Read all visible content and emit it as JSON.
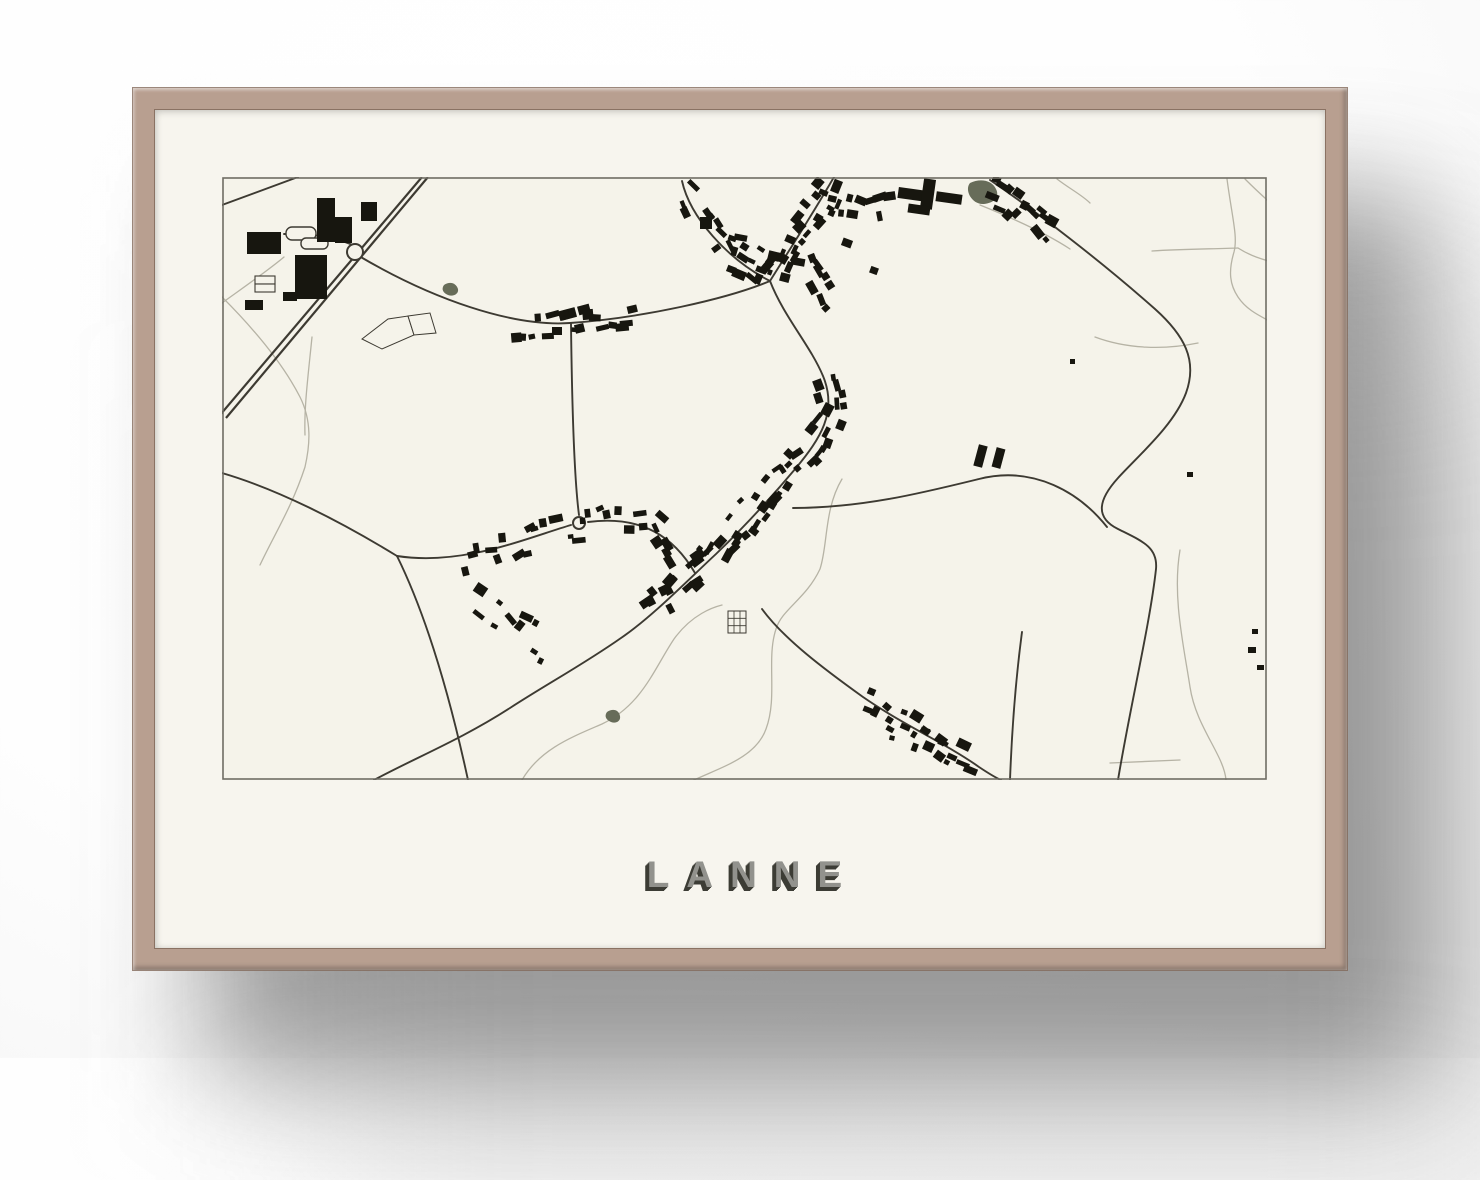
{
  "poster": {
    "title": "LANNE"
  },
  "colors": {
    "frame": "#b89f90",
    "frame_dark": "#8a7263",
    "mat": "#f7f5ee",
    "map_bg": "#f5f3ea",
    "map_border": "#6f6d64",
    "road_dark": "#3d3a32",
    "road_light": "#b6b3a5",
    "building": "#17160f",
    "water": "#676c59",
    "title_fill": "#92928d",
    "title_shadow": "#3c3c35"
  },
  "map": {
    "width": 1045,
    "height": 603,
    "highway": [
      "M206,0 L4,241",
      "M200,0 L-2,238"
    ],
    "roads_dark": [
      "M0,28 L76,0",
      "M137,79 C210,122 290,150 348,146 C420,141 505,122 548,104",
      "M460,4 C468,40 505,82 548,104",
      "M548,104 C568,72 590,38 612,0",
      "M548,104 C562,140 588,168 601,199 C616,235 598,262 574,291 C548,322 520,352 494,377 C467,402 430,440 399,461 C362,487 325,507 288,531 C240,562 195,580 152,603",
      "M571,331 C640,331 700,316 757,302 C812,288 858,316 885,350",
      "M768,3 C815,35 880,85 933,132 C962,158 976,183 964,216 C952,248 918,277 896,301 C877,322 872,340 896,352 C920,364 936,370 934,392 C928,447 908,530 896,603",
      "M540,432 C562,462 602,492 641,520 C683,549 725,567 757,590 C766,596 772,600 779,603",
      "M800,455 C794,500 790,550 788,603",
      "M0,296 C55,312 118,344 175,379",
      "M175,379 C240,389 302,362 349,348",
      "M366,345 C420,338 452,360 473,396",
      "M175,379 C205,440 228,520 246,603",
      "M357,338 C352,300 350,230 349,147",
      "M137,71 C115,60 95,57 62,57"
    ],
    "roads_light": [
      "M0,120 C30,150 60,185 78,220 C90,244 88,268 83,290 C70,330 52,358 38,388",
      "M0,126 C25,108 48,92 62,80",
      "M300,603 C318,572 350,560 380,547 C420,528 432,492 452,462 C470,437 492,430 500,428",
      "M620,302 C602,332 606,368 598,392 C584,422 560,432 554,452 C544,482 556,520 544,552 C534,580 500,590 472,603",
      "M758,28 C800,45 830,60 848,72",
      "M835,2 C848,12 860,18 868,26",
      "M873,160 C905,172 942,173 976,166",
      "M930,74 C960,72 990,72 1016,71",
      "M1005,2 C1010,40 1016,60 1012,75 C1006,95 1008,108 1016,120 C1028,138 1048,142 1060,152",
      "M1023,2 C1045,24 1072,48 1100,62",
      "M1016,71 C1030,80 1043,83 1060,88",
      "M958,373 C950,420 962,470 968,510 C974,550 1002,578 1004,603",
      "M888,586 L958,583",
      "M90,160 C86,200 82,230 83,258"
    ],
    "field_polys": [
      "M140,162 L166,142 L186,139 L192,158 L160,172 Z",
      "M186,139 L208,136 L214,156 L192,158 Z"
    ],
    "white_rects": [
      {
        "x": 33,
        "y": 99,
        "w": 20,
        "h": 8
      },
      {
        "x": 33,
        "y": 107,
        "w": 20,
        "h": 8
      }
    ],
    "pills": [
      {
        "x": 64,
        "y": 50,
        "w": 30,
        "h": 13,
        "rx": 6
      },
      {
        "x": 79,
        "y": 61,
        "w": 27,
        "h": 11,
        "rx": 5
      }
    ],
    "roundabouts": [
      {
        "cx": 133,
        "cy": 75,
        "r": 8
      },
      {
        "cx": 357,
        "cy": 346,
        "r": 6
      }
    ],
    "ponds": [
      "M748,6 C758,1 770,3 774,12 C778,20 772,26 762,27 C750,28 742,13 748,6 Z",
      "M222,108 C228,104 234,106 236,112 C237,117 231,120 226,118 C221,116 219,112 222,108 Z",
      "M385,535 C391,531 397,533 398,539 C399,544 394,547 389,545 C384,543 382,539 385,535 Z"
    ],
    "grid_structure": {
      "x": 506,
      "y": 434,
      "w": 18,
      "h": 22,
      "cols": 3,
      "rows": 3
    },
    "buildings": [
      [
        25,
        55,
        34,
        22,
        0
      ],
      [
        73,
        78,
        32,
        44,
        0
      ],
      [
        95,
        21,
        18,
        44,
        0
      ],
      [
        113,
        40,
        17,
        26,
        0
      ],
      [
        139,
        25,
        16,
        19,
        0
      ],
      [
        23,
        123,
        18,
        10,
        0
      ],
      [
        61,
        115,
        14,
        9,
        0
      ],
      [
        676,
        12,
        30,
        11,
        8
      ],
      [
        700,
        2,
        12,
        30,
        8
      ],
      [
        714,
        16,
        26,
        10,
        8
      ],
      [
        686,
        28,
        22,
        9,
        8
      ],
      [
        754,
        268,
        9,
        22,
        15
      ],
      [
        772,
        271,
        9,
        20,
        15
      ],
      [
        338,
        132,
        16,
        10,
        -15
      ],
      [
        356,
        128,
        12,
        9,
        -15
      ],
      [
        330,
        150,
        10,
        8,
        0
      ],
      [
        478,
        40,
        12,
        12,
        0
      ],
      [
        848,
        182,
        5,
        5,
        0
      ],
      [
        965,
        295,
        6,
        5,
        0
      ],
      [
        1026,
        470,
        8,
        6,
        0
      ],
      [
        1035,
        488,
        7,
        5,
        0
      ],
      [
        1030,
        452,
        6,
        5,
        0
      ],
      [
        620,
        62,
        10,
        8,
        20
      ],
      [
        648,
        90,
        8,
        7,
        20
      ]
    ],
    "clusters": [
      {
        "seed": 11,
        "path": [
          [
            290,
            152
          ],
          [
            348,
            146
          ],
          [
            418,
            142
          ]
        ],
        "count": 16,
        "spread": 9
      },
      {
        "seed": 12,
        "path": [
          [
            462,
            12
          ],
          [
            506,
            80
          ],
          [
            545,
            102
          ]
        ],
        "count": 14,
        "spread": 11
      },
      {
        "seed": 13,
        "path": [
          [
            550,
            100
          ],
          [
            582,
            52
          ],
          [
            612,
            6
          ]
        ],
        "count": 20,
        "spread": 12
      },
      {
        "seed": 14,
        "path": [
          [
            505,
            68
          ],
          [
            545,
            84
          ],
          [
            576,
            96
          ]
        ],
        "count": 12,
        "spread": 9
      },
      {
        "seed": 15,
        "path": [
          [
            598,
            22
          ],
          [
            640,
            36
          ],
          [
            672,
            30
          ]
        ],
        "count": 12,
        "spread": 9
      },
      {
        "seed": 16,
        "path": [
          [
            766,
            10
          ],
          [
            800,
            34
          ],
          [
            830,
            58
          ]
        ],
        "count": 16,
        "spread": 10
      },
      {
        "seed": 17,
        "path": [
          [
            601,
            200
          ],
          [
            611,
            236
          ],
          [
            590,
            270
          ],
          [
            558,
            302
          ],
          [
            522,
            342
          ],
          [
            492,
            378
          ],
          [
            458,
            410
          ],
          [
            428,
            434
          ]
        ],
        "count": 58,
        "spread": 12
      },
      {
        "seed": 18,
        "path": [
          [
            238,
            386
          ],
          [
            292,
            372
          ],
          [
            332,
            356
          ],
          [
            392,
            342
          ],
          [
            432,
            342
          ],
          [
            462,
            382
          ]
        ],
        "count": 28,
        "spread": 11
      },
      {
        "seed": 19,
        "path": [
          [
            252,
            420
          ],
          [
            292,
            452
          ],
          [
            330,
            472
          ]
        ],
        "count": 10,
        "spread": 14
      },
      {
        "seed": 20,
        "path": [
          [
            640,
            520
          ],
          [
            700,
            556
          ],
          [
            756,
            590
          ]
        ],
        "count": 16,
        "spread": 10
      },
      {
        "seed": 21,
        "path": [
          [
            584,
            82
          ],
          [
            600,
            108
          ],
          [
            612,
            128
          ]
        ],
        "count": 8,
        "spread": 8
      },
      {
        "seed": 22,
        "path": [
          [
            660,
            546
          ],
          [
            700,
            562
          ],
          [
            738,
            582
          ]
        ],
        "count": 8,
        "spread": 9
      }
    ]
  }
}
